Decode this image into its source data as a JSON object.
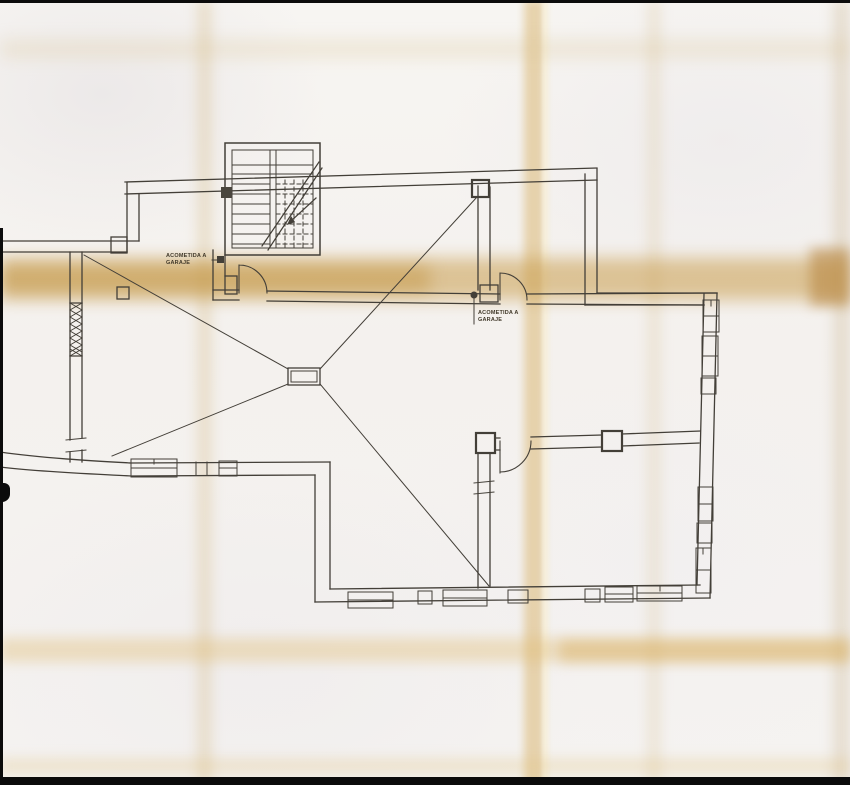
{
  "document": {
    "kind_label": "Scanned basement floor plan",
    "annotations": [
      {
        "id": "label-left",
        "line1": "ACOMETIDA A",
        "line2": "GARAJE"
      },
      {
        "id": "label-right",
        "line1": "ACOMETIDA A",
        "line2": "GARAJE"
      }
    ],
    "colors": {
      "paper": "#f4f1ee",
      "ink": "#3f3c36",
      "fold_crease": "#d9b76a",
      "scan_edge": "#0b0b0b"
    }
  }
}
